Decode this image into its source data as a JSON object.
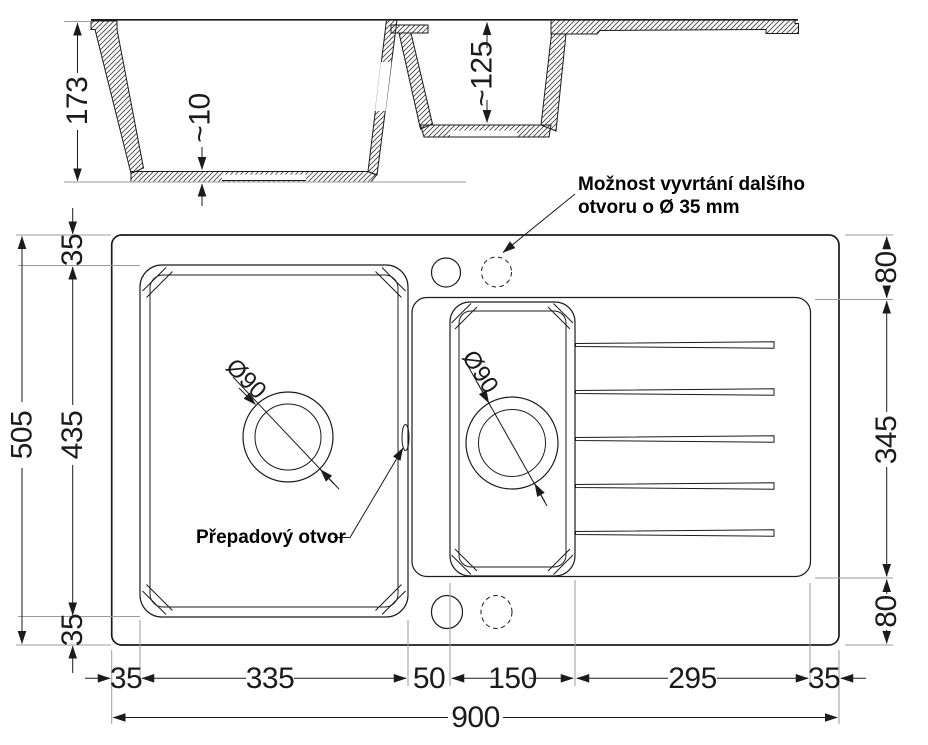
{
  "drawing_title": "Kitchen sink dimensional drawing",
  "colors": {
    "line": "#1b1b1b",
    "extension_line": "#9b9b9b",
    "background": "#ffffff"
  },
  "section": {
    "depth_total": "173",
    "bottom_thickness": "~10",
    "small_basin_depth": "~125"
  },
  "plan": {
    "left_dims": {
      "total": "505",
      "rim_top": "35",
      "basin": "435",
      "rim_bottom": "35"
    },
    "right_dims": {
      "deck_top": "80",
      "middle": "345",
      "deck_bottom": "80"
    },
    "bottom_dims": {
      "rim_left": "35",
      "main_basin": "335",
      "divider": "50",
      "small_basin": "150",
      "drainboard": "295",
      "rim_right": "35",
      "total": "900"
    },
    "main_drain_diameter": "Ø90",
    "small_drain_diameter": "Ø90"
  },
  "annotations": {
    "extra_hole_line1": "Možnost vyvrtání dalšího",
    "extra_hole_line2": "otvoru o Ø 35 mm",
    "overflow_label": "Přepadový otvor"
  }
}
